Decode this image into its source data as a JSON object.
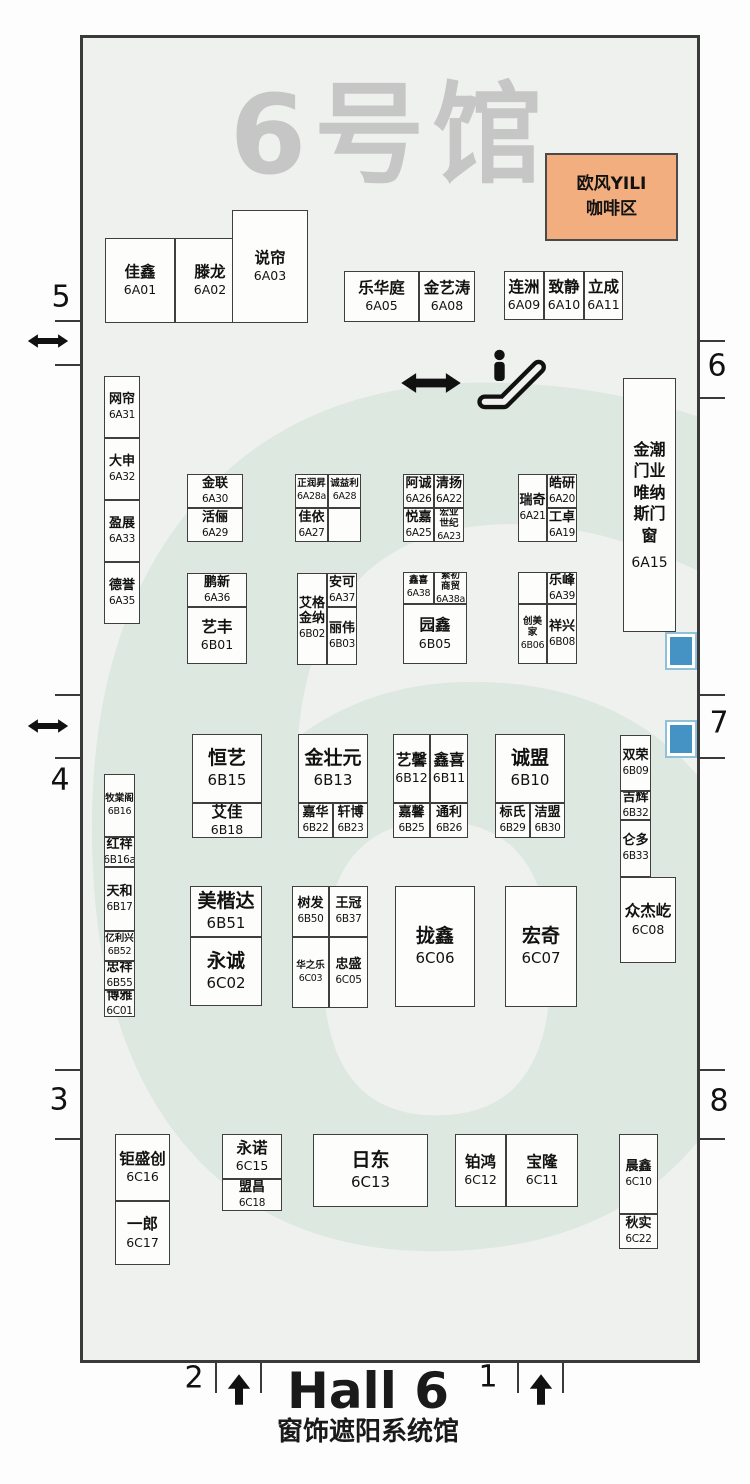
{
  "hall": {
    "watermark_title": "6号馆",
    "watermark_digit": "6",
    "footer_title": "Hall 6",
    "footer_subtitle": "窗饰遮阳系统馆"
  },
  "coffee": {
    "line1": "欧风YILI",
    "line2": "咖啡区"
  },
  "colors": {
    "hall_bg": "#eff1ee",
    "watermark_gray": "#c6c6c6",
    "watermark_digit": "#dde8e1",
    "coffee_bg": "#f2ae7e",
    "booth_border": "#3f3f3f",
    "wall": "#3a3a3a",
    "blue_marker": "#4493c4"
  },
  "icons": [
    {
      "name": "passage-double-arrow-icon",
      "meaning": "two-way passage"
    },
    {
      "name": "escalator-icon",
      "meaning": "escalator"
    },
    {
      "name": "entrance-up-arrow-icon",
      "meaning": "entrance direction"
    }
  ],
  "gates": [
    {
      "label": "5",
      "x": 61,
      "y": 297
    },
    {
      "label": "6",
      "x": 717,
      "y": 366
    },
    {
      "label": "4",
      "x": 60,
      "y": 780
    },
    {
      "label": "7",
      "x": 719,
      "y": 723
    },
    {
      "label": "3",
      "x": 59,
      "y": 1100
    },
    {
      "label": "8",
      "x": 719,
      "y": 1101
    },
    {
      "label": "2",
      "x": 194,
      "y": 1378
    },
    {
      "label": "1",
      "x": 488,
      "y": 1377
    }
  ],
  "booths": [
    {
      "name": "佳鑫",
      "id": "6A01",
      "x": 105,
      "y": 238,
      "w": 70,
      "h": 85,
      "cls": "md"
    },
    {
      "name": "滕龙",
      "id": "6A02",
      "x": 175,
      "y": 238,
      "w": 70,
      "h": 85,
      "cls": "md"
    },
    {
      "name": "说帘",
      "id": "6A03",
      "x": 232,
      "y": 210,
      "w": 76,
      "h": 113,
      "cls": "md"
    },
    {
      "name": "乐华庭",
      "id": "6A05",
      "x": 344,
      "y": 271,
      "w": 75,
      "h": 51,
      "cls": "md"
    },
    {
      "name": "金艺涛",
      "id": "6A08",
      "x": 419,
      "y": 271,
      "w": 56,
      "h": 51,
      "cls": "md"
    },
    {
      "name": "连洲",
      "id": "6A09",
      "x": 504,
      "y": 271,
      "w": 40,
      "h": 49,
      "cls": "md"
    },
    {
      "name": "致静",
      "id": "6A10",
      "x": 544,
      "y": 271,
      "w": 40,
      "h": 49,
      "cls": "md"
    },
    {
      "name": "立成",
      "id": "6A11",
      "x": 584,
      "y": 271,
      "w": 39,
      "h": 49,
      "cls": "md"
    },
    {
      "name": "网帘",
      "id": "6A31",
      "x": 104,
      "y": 376,
      "w": 36,
      "h": 62,
      "cls": "sm"
    },
    {
      "name": "大申",
      "id": "6A32",
      "x": 104,
      "y": 438,
      "w": 36,
      "h": 62,
      "cls": "sm"
    },
    {
      "name": "盈展",
      "id": "6A33",
      "x": 104,
      "y": 500,
      "w": 36,
      "h": 62,
      "cls": "sm"
    },
    {
      "name": "德誉",
      "id": "6A35",
      "x": 104,
      "y": 562,
      "w": 36,
      "h": 62,
      "cls": "sm"
    },
    {
      "name": "金联",
      "id": "6A30",
      "x": 187,
      "y": 474,
      "w": 56,
      "h": 34,
      "cls": "sm"
    },
    {
      "name": "活俪",
      "id": "6A29",
      "x": 187,
      "y": 508,
      "w": 56,
      "h": 34,
      "cls": "sm"
    },
    {
      "name": "正润昇",
      "id": "6A28a",
      "x": 295,
      "y": 474,
      "w": 33,
      "h": 34,
      "cls": "xs"
    },
    {
      "name": "诚益利",
      "id": "6A28",
      "x": 328,
      "y": 474,
      "w": 33,
      "h": 34,
      "cls": "xs"
    },
    {
      "name": "佳依",
      "id": "6A27",
      "x": 295,
      "y": 508,
      "w": 33,
      "h": 34,
      "cls": "sm"
    },
    {
      "name": "",
      "id": "",
      "x": 328,
      "y": 508,
      "w": 33,
      "h": 34,
      "cls": "sm"
    },
    {
      "name": "阿诚",
      "id": "6A26",
      "x": 403,
      "y": 474,
      "w": 31,
      "h": 34,
      "cls": "sm"
    },
    {
      "name": "清扬",
      "id": "6A22",
      "x": 434,
      "y": 474,
      "w": 30,
      "h": 34,
      "cls": "sm"
    },
    {
      "name": "悦嘉",
      "id": "6A25",
      "x": 403,
      "y": 508,
      "w": 31,
      "h": 34,
      "cls": "sm"
    },
    {
      "name": "宏业\n世纪",
      "id": "6A23",
      "x": 434,
      "y": 508,
      "w": 30,
      "h": 34,
      "cls": "xs"
    },
    {
      "name": "瑞奇",
      "id": "6A21",
      "x": 518,
      "y": 474,
      "w": 29,
      "h": 68,
      "cls": "sm"
    },
    {
      "name": "皓研",
      "id": "6A20",
      "x": 547,
      "y": 474,
      "w": 30,
      "h": 34,
      "cls": "sm"
    },
    {
      "name": "工卓",
      "id": "6A19",
      "x": 547,
      "y": 508,
      "w": 30,
      "h": 34,
      "cls": "sm"
    },
    {
      "name": "鹏新",
      "id": "6A36",
      "x": 187,
      "y": 573,
      "w": 60,
      "h": 34,
      "cls": "sm"
    },
    {
      "name": "艺丰",
      "id": "6B01",
      "x": 187,
      "y": 607,
      "w": 60,
      "h": 57,
      "cls": "md"
    },
    {
      "name": "艾格\n金纳",
      "id": "6B02",
      "x": 297,
      "y": 573,
      "w": 30,
      "h": 92,
      "cls": "sm"
    },
    {
      "name": "安可",
      "id": "6A37",
      "x": 327,
      "y": 573,
      "w": 30,
      "h": 34,
      "cls": "sm"
    },
    {
      "name": "丽伟",
      "id": "6B03",
      "x": 327,
      "y": 607,
      "w": 30,
      "h": 58,
      "cls": "sm"
    },
    {
      "name": "鑫喜",
      "id": "6A38",
      "x": 403,
      "y": 572,
      "w": 31,
      "h": 32,
      "cls": "xs"
    },
    {
      "name": "繁初\n商贸",
      "id": "6A38a",
      "x": 434,
      "y": 572,
      "w": 33,
      "h": 32,
      "cls": "xs"
    },
    {
      "name": "园鑫",
      "id": "6B05",
      "x": 403,
      "y": 604,
      "w": 64,
      "h": 60,
      "cls": "md"
    },
    {
      "name": "",
      "id": "",
      "x": 518,
      "y": 572,
      "w": 29,
      "h": 32,
      "cls": "sm"
    },
    {
      "name": "乐峰",
      "id": "6A39",
      "x": 547,
      "y": 572,
      "w": 30,
      "h": 32,
      "cls": "sm"
    },
    {
      "name": "创美家",
      "id": "6B06",
      "x": 518,
      "y": 604,
      "w": 29,
      "h": 60,
      "cls": "xs"
    },
    {
      "name": "祥兴",
      "id": "6B08",
      "x": 547,
      "y": 604,
      "w": 30,
      "h": 60,
      "cls": "sm"
    },
    {
      "name": "金潮\n门业\n唯纳\n斯门\n窗",
      "id": "6A15",
      "x": 623,
      "y": 378,
      "w": 53,
      "h": 254,
      "cls": "tall"
    },
    {
      "name": "恒艺",
      "id": "6B15",
      "x": 192,
      "y": 734,
      "w": 70,
      "h": 69,
      "cls": "lg"
    },
    {
      "name": "艾佳",
      "id": "6B18",
      "x": 192,
      "y": 803,
      "w": 70,
      "h": 35,
      "cls": "md"
    },
    {
      "name": "金壮元",
      "id": "6B13",
      "x": 298,
      "y": 734,
      "w": 70,
      "h": 69,
      "cls": "lg"
    },
    {
      "name": "嘉华",
      "id": "6B22",
      "x": 298,
      "y": 803,
      "w": 35,
      "h": 35,
      "cls": "sm"
    },
    {
      "name": "轩博",
      "id": "6B23",
      "x": 333,
      "y": 803,
      "w": 35,
      "h": 35,
      "cls": "sm"
    },
    {
      "name": "艺馨",
      "id": "6B12",
      "x": 393,
      "y": 734,
      "w": 37,
      "h": 69,
      "cls": "md"
    },
    {
      "name": "鑫喜",
      "id": "6B11",
      "x": 430,
      "y": 734,
      "w": 38,
      "h": 69,
      "cls": "md"
    },
    {
      "name": "嘉馨",
      "id": "6B25",
      "x": 393,
      "y": 803,
      "w": 37,
      "h": 35,
      "cls": "sm"
    },
    {
      "name": "通利",
      "id": "6B26",
      "x": 430,
      "y": 803,
      "w": 38,
      "h": 35,
      "cls": "sm"
    },
    {
      "name": "诚盟",
      "id": "6B10",
      "x": 495,
      "y": 734,
      "w": 70,
      "h": 69,
      "cls": "lg"
    },
    {
      "name": "标氏",
      "id": "6B29",
      "x": 495,
      "y": 803,
      "w": 35,
      "h": 35,
      "cls": "sm"
    },
    {
      "name": "洁盟",
      "id": "6B30",
      "x": 530,
      "y": 803,
      "w": 35,
      "h": 35,
      "cls": "sm"
    },
    {
      "name": "双荣",
      "id": "6B09",
      "x": 620,
      "y": 735,
      "w": 31,
      "h": 56,
      "cls": "sm"
    },
    {
      "name": "吉辉",
      "id": "6B32",
      "x": 620,
      "y": 791,
      "w": 31,
      "h": 29,
      "cls": "sm"
    },
    {
      "name": "仑多",
      "id": "6B33",
      "x": 620,
      "y": 820,
      "w": 31,
      "h": 57,
      "cls": "sm"
    },
    {
      "name": "众杰屹",
      "id": "6C08",
      "x": 620,
      "y": 877,
      "w": 56,
      "h": 86,
      "cls": "md"
    },
    {
      "name": "牧棠阁",
      "id": "6B16",
      "x": 104,
      "y": 774,
      "w": 31,
      "h": 63,
      "cls": "xs"
    },
    {
      "name": "红祥",
      "id": "6B16a",
      "x": 104,
      "y": 837,
      "w": 31,
      "h": 30,
      "cls": "sm"
    },
    {
      "name": "天和",
      "id": "6B17",
      "x": 104,
      "y": 867,
      "w": 31,
      "h": 64,
      "cls": "sm"
    },
    {
      "name": "亿利兴",
      "id": "6B52",
      "x": 104,
      "y": 931,
      "w": 31,
      "h": 30,
      "cls": "xs"
    },
    {
      "name": "忠祥",
      "id": "6B55",
      "x": 104,
      "y": 961,
      "w": 31,
      "h": 29,
      "cls": "sm"
    },
    {
      "name": "博雅",
      "id": "6C01",
      "x": 104,
      "y": 990,
      "w": 31,
      "h": 27,
      "cls": "sm"
    },
    {
      "name": "美楷达",
      "id": "6B51",
      "x": 190,
      "y": 886,
      "w": 72,
      "h": 51,
      "cls": "lg"
    },
    {
      "name": "永诚",
      "id": "6C02",
      "x": 190,
      "y": 937,
      "w": 72,
      "h": 69,
      "cls": "lg"
    },
    {
      "name": "树发",
      "id": "6B50",
      "x": 292,
      "y": 886,
      "w": 37,
      "h": 51,
      "cls": "sm"
    },
    {
      "name": "王冠",
      "id": "6B37",
      "x": 329,
      "y": 886,
      "w": 39,
      "h": 51,
      "cls": "sm"
    },
    {
      "name": "华之乐",
      "id": "6C03",
      "x": 292,
      "y": 937,
      "w": 37,
      "h": 71,
      "cls": "xs"
    },
    {
      "name": "忠盛",
      "id": "6C05",
      "x": 329,
      "y": 937,
      "w": 39,
      "h": 71,
      "cls": "sm"
    },
    {
      "name": "拢鑫",
      "id": "6C06",
      "x": 395,
      "y": 886,
      "w": 80,
      "h": 121,
      "cls": "lg"
    },
    {
      "name": "宏奇",
      "id": "6C07",
      "x": 505,
      "y": 886,
      "w": 72,
      "h": 121,
      "cls": "lg"
    },
    {
      "name": "钜盛创",
      "id": "6C16",
      "x": 115,
      "y": 1134,
      "w": 55,
      "h": 67,
      "cls": "md"
    },
    {
      "name": "一郎",
      "id": "6C17",
      "x": 115,
      "y": 1201,
      "w": 55,
      "h": 64,
      "cls": "md"
    },
    {
      "name": "永诺",
      "id": "6C15",
      "x": 222,
      "y": 1134,
      "w": 60,
      "h": 45,
      "cls": "md"
    },
    {
      "name": "盟昌",
      "id": "6C18",
      "x": 222,
      "y": 1179,
      "w": 60,
      "h": 32,
      "cls": "sm"
    },
    {
      "name": "日东",
      "id": "6C13",
      "x": 313,
      "y": 1134,
      "w": 115,
      "h": 73,
      "cls": "lg"
    },
    {
      "name": "铂鸿",
      "id": "6C12",
      "x": 455,
      "y": 1134,
      "w": 51,
      "h": 73,
      "cls": "md"
    },
    {
      "name": "宝隆",
      "id": "6C11",
      "x": 506,
      "y": 1134,
      "w": 72,
      "h": 73,
      "cls": "md"
    },
    {
      "name": "晨鑫",
      "id": "6C10",
      "x": 619,
      "y": 1134,
      "w": 39,
      "h": 80,
      "cls": "sm"
    },
    {
      "name": "秋实",
      "id": "6C22",
      "x": 619,
      "y": 1214,
      "w": 39,
      "h": 35,
      "cls": "sm"
    }
  ]
}
